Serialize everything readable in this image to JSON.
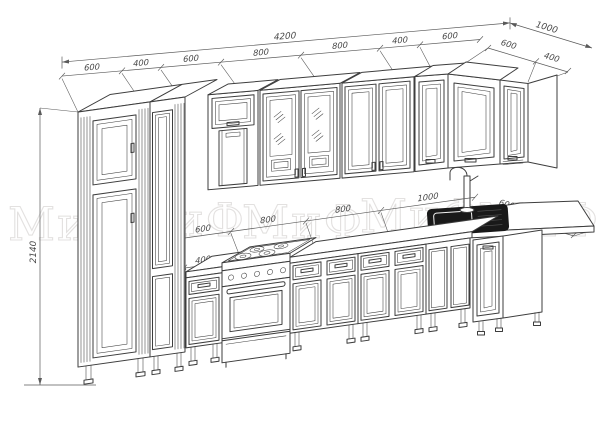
{
  "watermark": {
    "text": "МиФ"
  },
  "dimensions": {
    "overall_width": "4200",
    "overall_depth": "1000",
    "overall_height": "2140",
    "upper_front": [
      "600",
      "400",
      "600",
      "800",
      "800",
      "400",
      "600"
    ],
    "upper_right": [
      "600",
      "400"
    ],
    "base_front": [
      "400",
      "600",
      "800",
      "800",
      "1000"
    ],
    "base_right": [
      "600",
      "400"
    ]
  },
  "colors": {
    "line": "#3d3d3d",
    "dimension_text": "#474747",
    "watermark": "#e3e1e0",
    "sink_basin": "#191919",
    "background": "#ffffff"
  }
}
